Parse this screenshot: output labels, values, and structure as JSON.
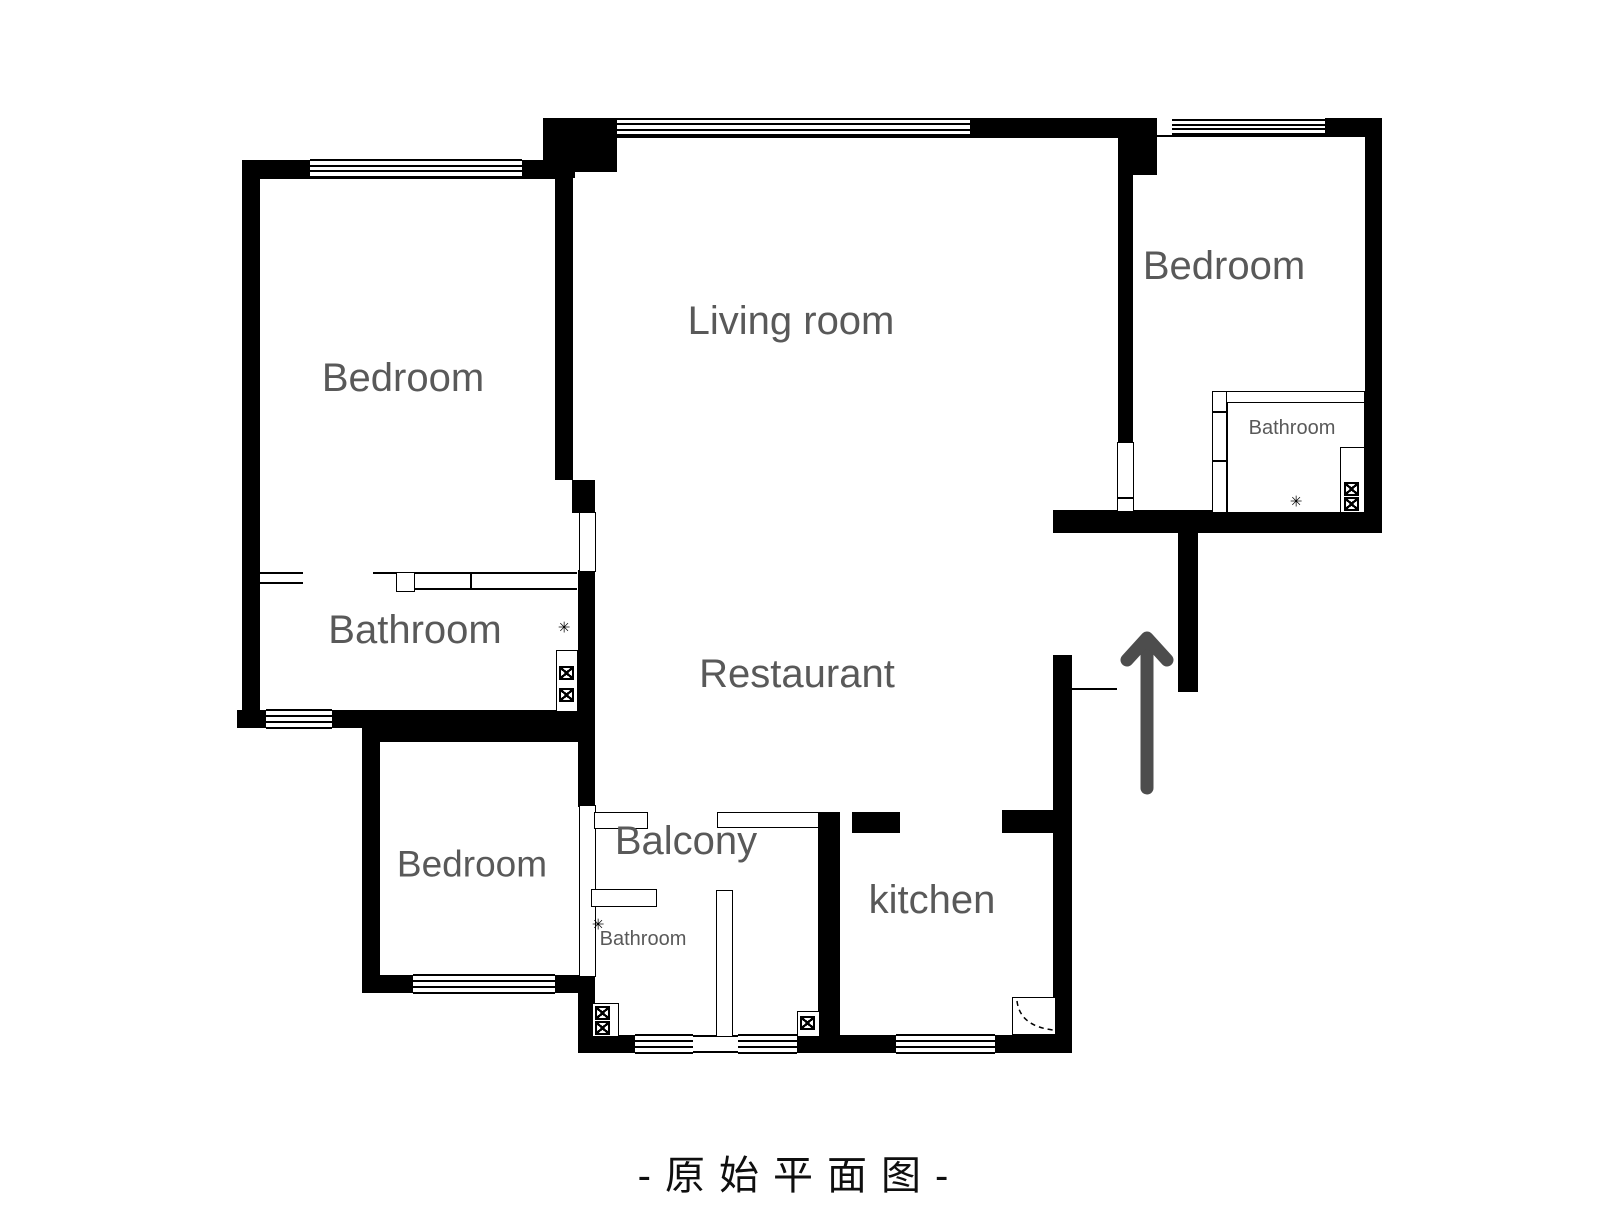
{
  "caption": "-原始平面图-",
  "labels": {
    "bedroom_top_left": "Bedroom",
    "living_room": "Living room",
    "bedroom_right": "Bedroom",
    "bathroom_left": "Bathroom",
    "restaurant": "Restaurant",
    "bedroom_bottom": "Bedroom",
    "balcony": "Balcony",
    "bathroom_balcony": "Bathroom",
    "kitchen": "kitchen",
    "bathroom_right": "Bathroom"
  },
  "icons": {
    "shower_glyph": "✳",
    "entry_arrow": "up-arrow",
    "valve_box": "crossed-square"
  },
  "colors": {
    "wall": "#000000",
    "label": "#595959",
    "arrow": "#4d4d4d",
    "caption": "#0f0f0f",
    "background": "#ffffff"
  }
}
